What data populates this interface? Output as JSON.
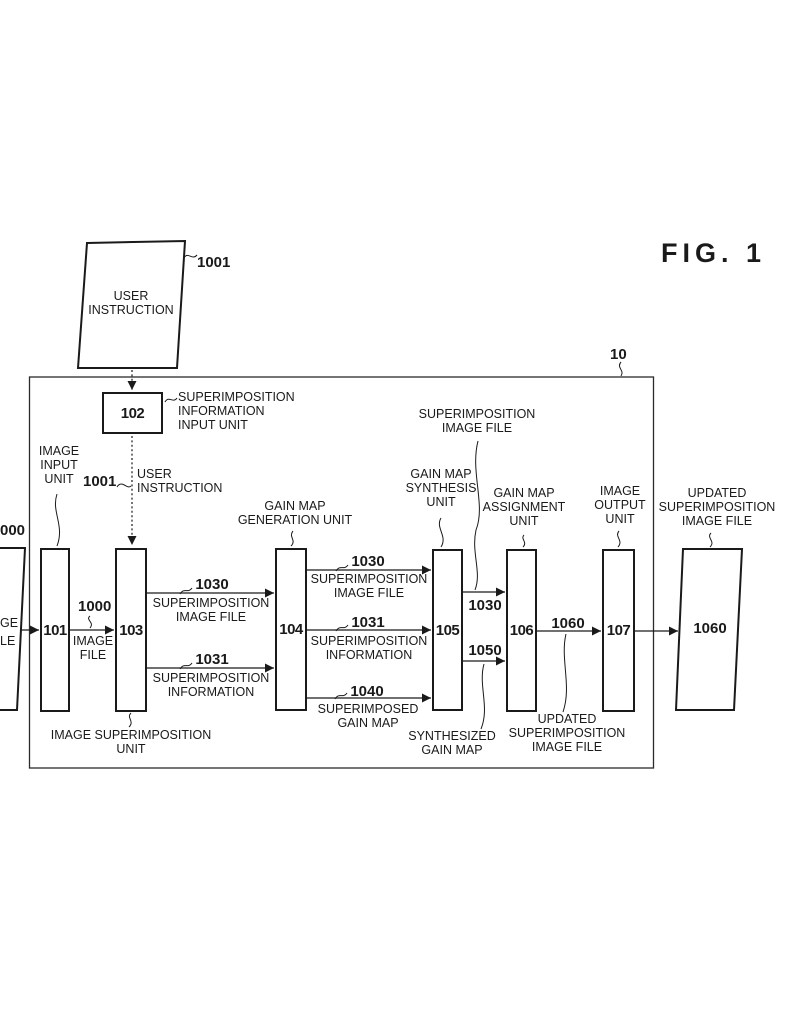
{
  "colors": {
    "ink": "#1a1a1a",
    "background": "#ffffff"
  },
  "figure": {
    "label": "FIG. 1",
    "system_ref": "10"
  },
  "external": {
    "user_instruction": {
      "ref": "1001",
      "text": "USER\nINSTRUCTION"
    },
    "input_file_fragments": {
      "ref": "000",
      "line1": "GE",
      "line2": "LE"
    },
    "output_file": {
      "ref": "1060",
      "caption": "UPDATED\nSUPERIMPOSITION\nIMAGE FILE"
    }
  },
  "units": {
    "u101": {
      "num": "101",
      "caption": "IMAGE\nINPUT\nUNIT"
    },
    "u102": {
      "num": "102",
      "caption": "SUPERIMPOSITION\nINFORMATION\nINPUT UNIT"
    },
    "u103": {
      "num": "103",
      "caption": "IMAGE SUPERIMPOSITION\nUNIT"
    },
    "u104": {
      "num": "104",
      "caption": "GAIN MAP\nGENERATION UNIT"
    },
    "u105": {
      "num": "105",
      "caption": "GAIN MAP\nSYNTHESIS\nUNIT"
    },
    "u106": {
      "num": "106",
      "caption": "GAIN MAP\nASSIGNMENT\nUNIT"
    },
    "u107": {
      "num": "107",
      "caption": "IMAGE\nOUTPUT\nUNIT"
    }
  },
  "flows": {
    "user_instruction": {
      "ref": "1001",
      "label": "USER\nINSTRUCTION"
    },
    "image_file": {
      "ref": "1000",
      "label": "IMAGE\nFILE"
    },
    "sif_a": {
      "ref": "1030",
      "label": "SUPERIMPOSITION\nIMAGE FILE"
    },
    "si_a": {
      "ref": "1031",
      "label": "SUPERIMPOSITION\nINFORMATION"
    },
    "sif_b": {
      "ref": "1030",
      "label": "SUPERIMPOSITION\nIMAGE FILE"
    },
    "si_b": {
      "ref": "1031",
      "label": "SUPERIMPOSITION\nINFORMATION"
    },
    "superimposed_gain_map": {
      "ref": "1040",
      "label": "SUPERIMPOSED\nGAIN MAP"
    },
    "sif_c": {
      "ref": "1030",
      "label": "SUPERIMPOSITION\nIMAGE FILE"
    },
    "synthesized_gain_map": {
      "ref": "1050",
      "label": "SYNTHESIZED\nGAIN MAP"
    },
    "updated_sif": {
      "ref": "1060",
      "label": "UPDATED\nSUPERIMPOSITION\nIMAGE FILE"
    }
  }
}
